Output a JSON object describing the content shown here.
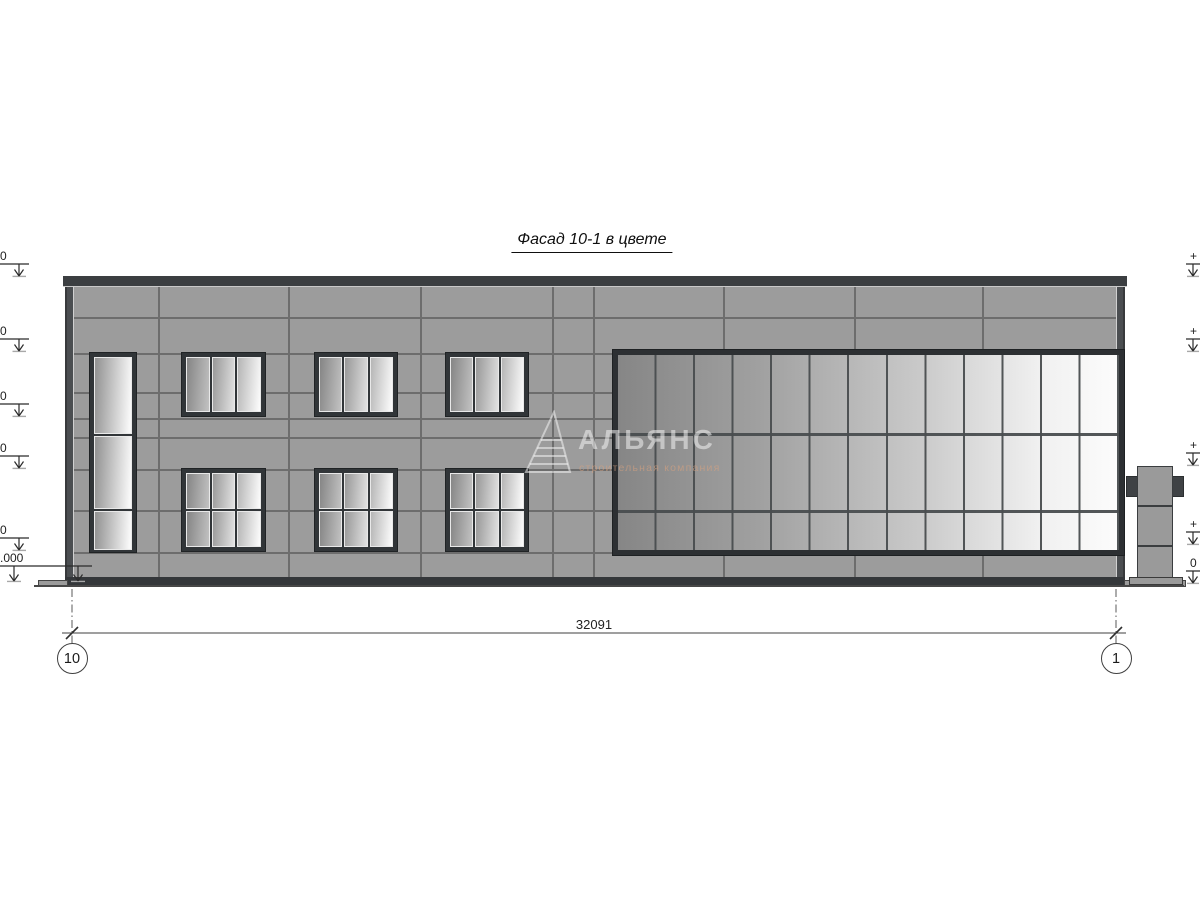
{
  "title": "Фасад 10-1 в цвете",
  "dimension_line": {
    "value": "32091"
  },
  "grid_axes": [
    {
      "label": "10"
    },
    {
      "label": "1"
    }
  ],
  "elevation_markers": {
    "left": [
      {
        "fragment": "0"
      },
      {
        "fragment": "0"
      },
      {
        "fragment": "0"
      },
      {
        "fragment": "0"
      },
      {
        "fragment": "0"
      },
      {
        "fragment": ".000"
      }
    ],
    "right": [
      {
        "fragment": "+"
      },
      {
        "fragment": "+"
      },
      {
        "fragment": "+"
      },
      {
        "fragment": "+"
      },
      {
        "fragment": "0"
      }
    ]
  },
  "watermark": {
    "name": "АЛЬЯНС",
    "tagline": "строительная компания",
    "logo": "triangle-logo"
  },
  "colors": {
    "wall": "#9c9c9c",
    "coping": "#3b3e41",
    "window_frame": "#313538",
    "glass_dark": "#868686",
    "glass_light": "#fcfcfc",
    "seam": "#6d6d6d",
    "drawing_line": "#3f3f3f"
  }
}
